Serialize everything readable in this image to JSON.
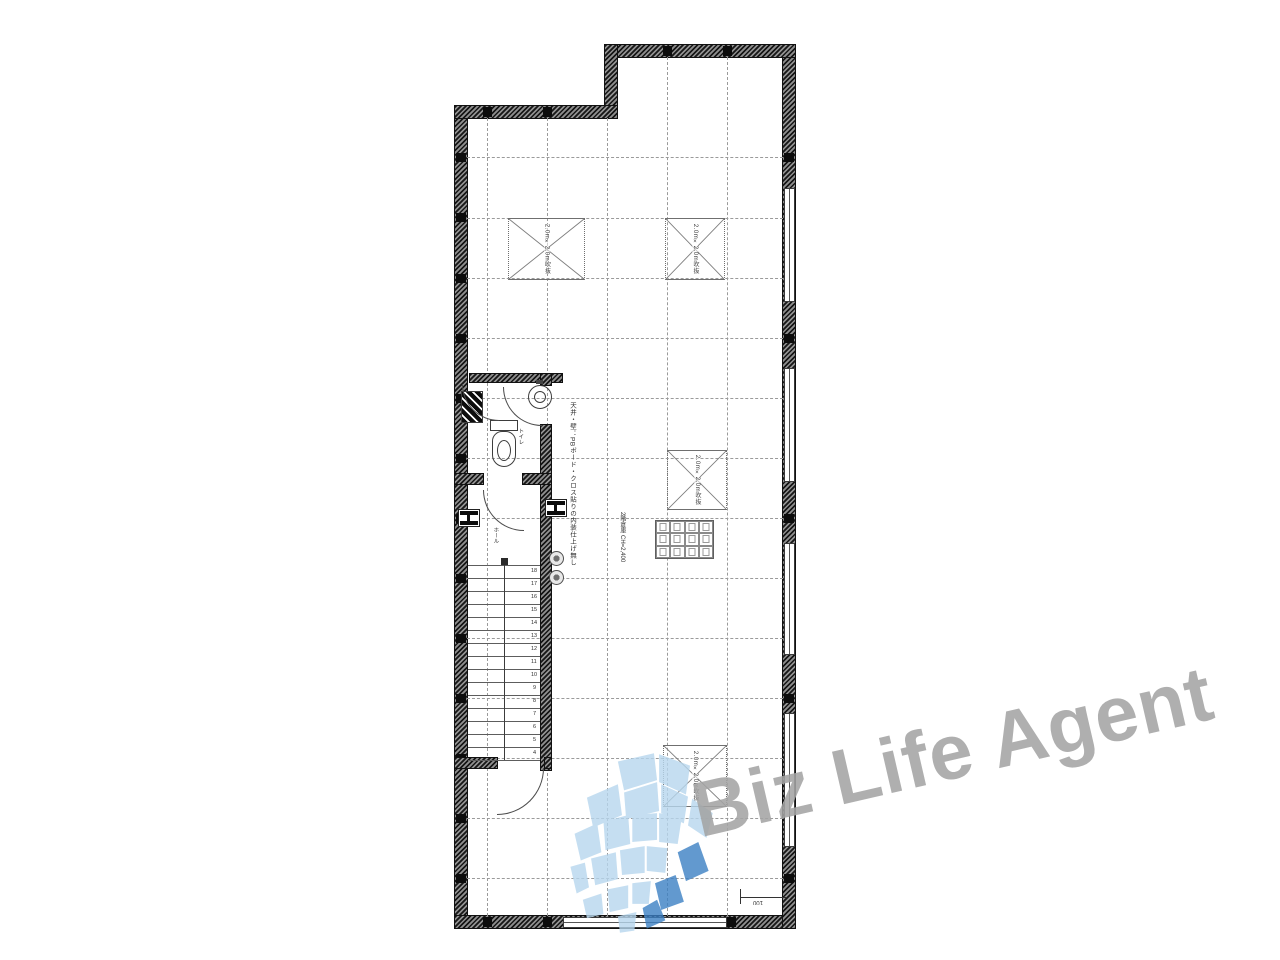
{
  "watermark": {
    "text": "Biz Life Agent",
    "text_color": "#a4a4a4",
    "logo_light_color": "#b7d7ee",
    "logo_dark_color": "#3c80c4"
  },
  "plan": {
    "labels": {
      "annotation_vertical": "天井・壁：PBボード・クロス貼りの内装仕上げ無し",
      "void_label_1": "2.0m×2.0m吹抜",
      "void_label_2": "2.0m×2.0m吹抜",
      "void_label_3": "2.0m×2.0m吹抜",
      "void_label_4": "2.0m×2.0m吹抜",
      "storage_spec_line": "2階倉庫 CH=2,400",
      "hall_label": "ホール",
      "toilet_label": "トイレ",
      "scale_text": "100"
    },
    "stairs": {
      "numbers": [
        "18",
        "17",
        "16",
        "15",
        "14",
        "13",
        "12",
        "11",
        "10",
        "9",
        "8",
        "7",
        "6",
        "5",
        "4"
      ]
    }
  }
}
